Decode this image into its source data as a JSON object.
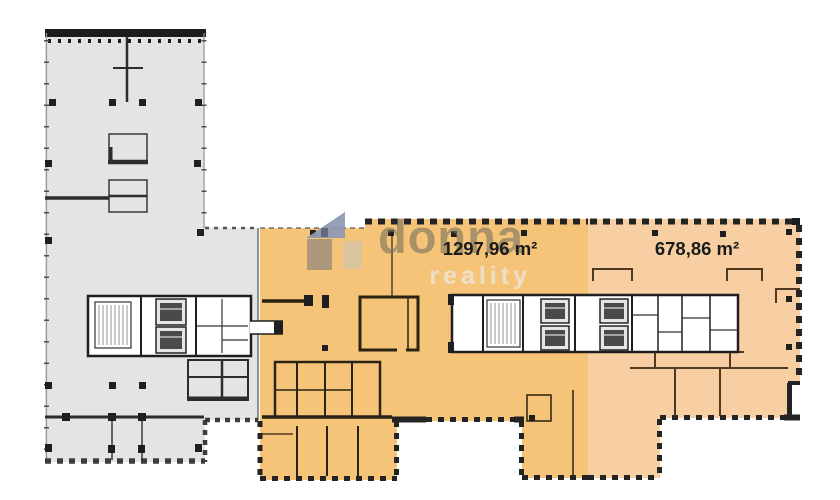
{
  "document": {
    "type": "floor-plan",
    "background": "#ffffff"
  },
  "watermark": {
    "brand": "donna",
    "brand_sub": "reality",
    "house_icon": "donna-logo-house-icon",
    "roof_color": "#8d97b2",
    "body_left_color": "#9f8f7a",
    "body_right_color": "#d2c4a8",
    "brand_color": "#76705f",
    "sub_color": "#ece4d2"
  },
  "regions": [
    {
      "id": "left-wing",
      "name": "left wing (not offered)",
      "fill": "#e4e4e4",
      "area_label": ""
    },
    {
      "id": "unit-large",
      "name": "highlighted unit large",
      "fill": "#f6c478",
      "area_label": "1297,96 m²"
    },
    {
      "id": "unit-small",
      "name": "highlighted unit small",
      "fill": "#f8cfa3",
      "area_label": "678,86 m²"
    }
  ],
  "colors": {
    "wall_dark": "#1f1f1f",
    "wall_gray": "#2c2c2c",
    "wall_brown": "#4a3a20",
    "dash_border": "#242424",
    "dash_border_gray": "#3c3c3c",
    "core_fill": "#ffffff",
    "label_text": "#1b1b1b"
  }
}
